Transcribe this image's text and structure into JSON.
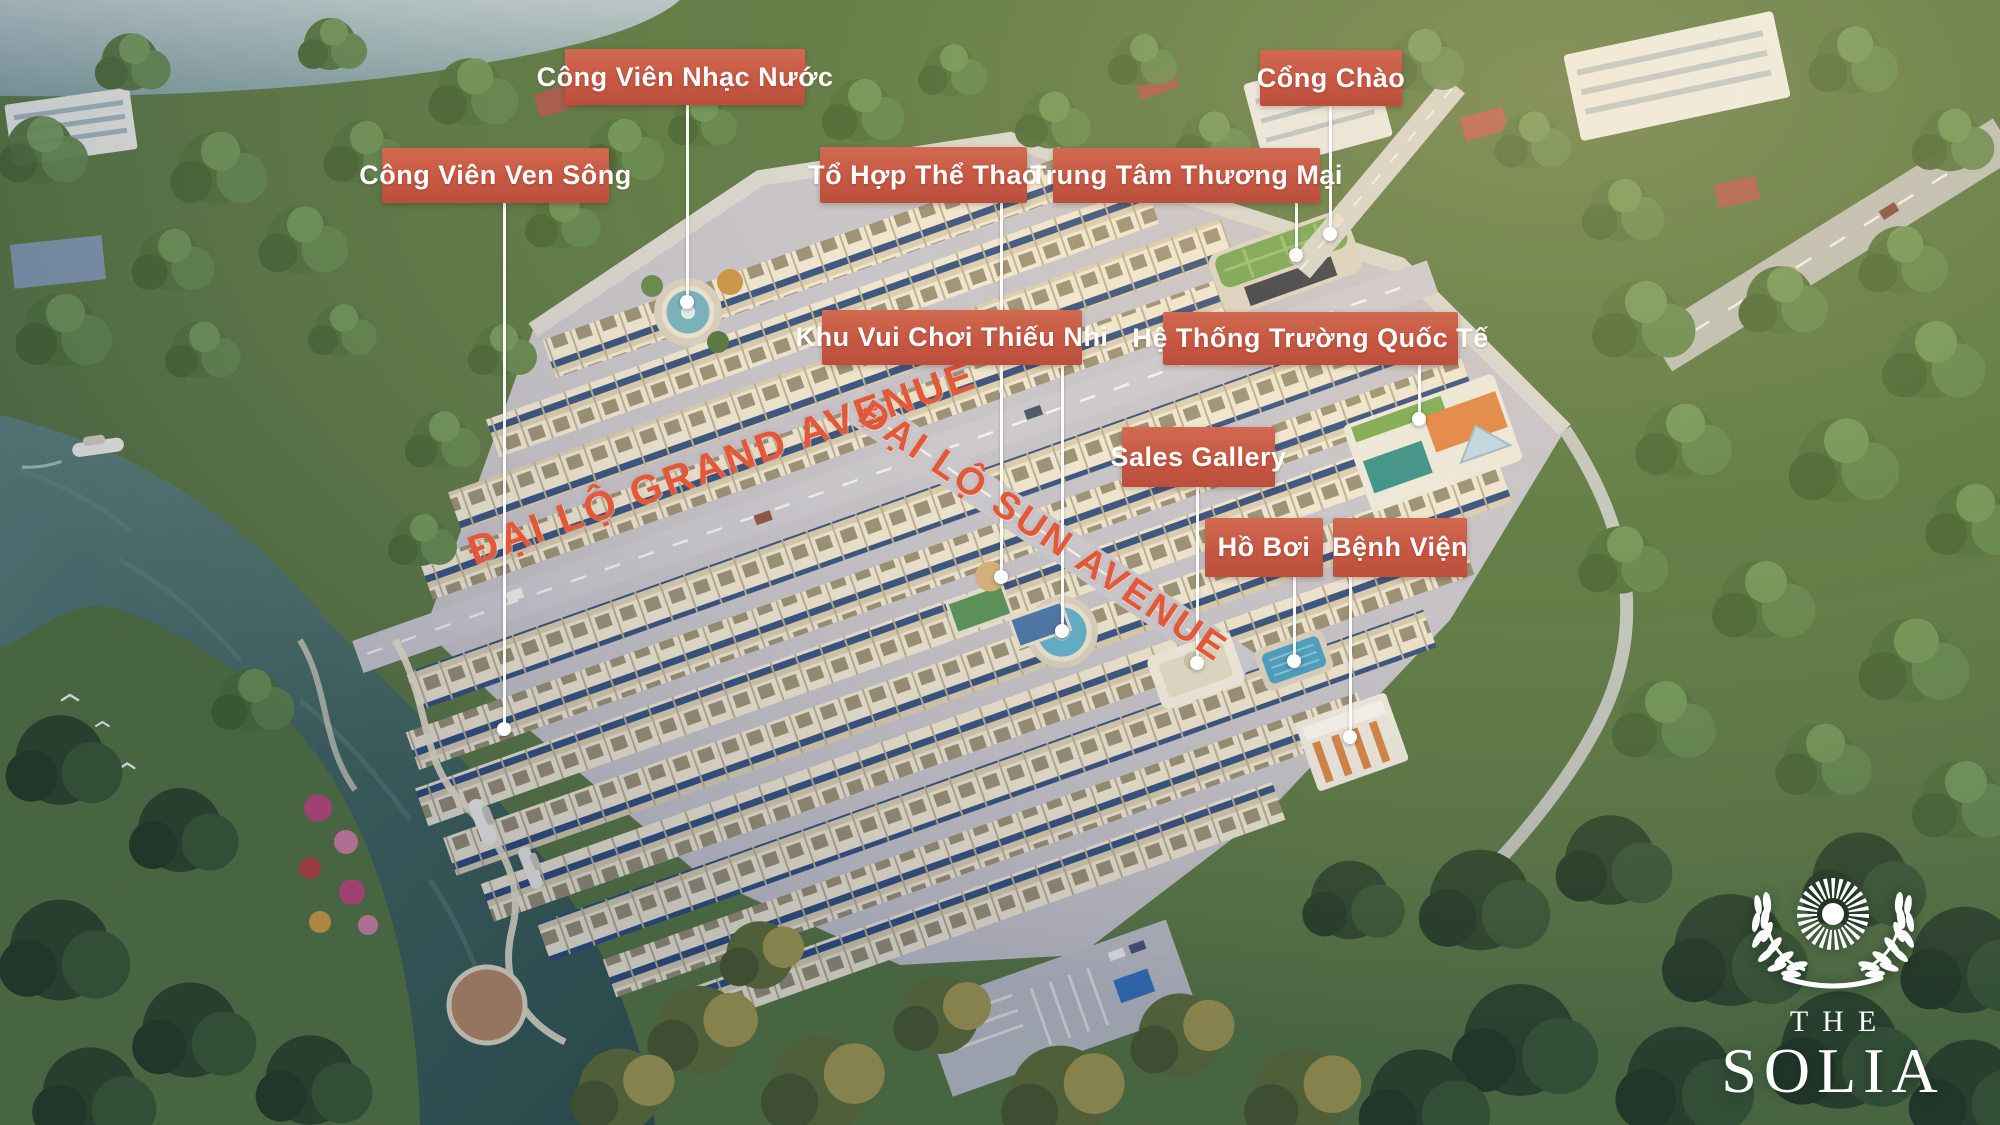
{
  "canvas": {
    "width": 2000,
    "height": 1125
  },
  "colors": {
    "callout_bg": "#c65843",
    "callout_text": "#ffffff",
    "street_text": "#e4583a",
    "leader_line": "#ffffff",
    "river": "#3d625c",
    "lake": "#9fb6bd",
    "forest": "#4e7040",
    "roof_cream": "#efe8d4",
    "facade_navy": "#2c4a7e"
  },
  "callouts": [
    {
      "id": "cong-vien-nhac-nuoc",
      "text": "Công Viên Nhạc Nước",
      "box": {
        "x": 565,
        "y": 49,
        "w": 240,
        "h": 56
      },
      "line": {
        "x": 687,
        "y1": 105,
        "y2": 300
      }
    },
    {
      "id": "cong-chao",
      "text": "Cổng Chào",
      "box": {
        "x": 1260,
        "y": 50,
        "w": 142,
        "h": 56
      },
      "line": {
        "x": 1330,
        "y1": 106,
        "y2": 232
      }
    },
    {
      "id": "cong-vien-ven-song",
      "text": "Công Viên Ven Sông",
      "box": {
        "x": 382,
        "y": 148,
        "w": 227,
        "h": 55
      },
      "line": {
        "x": 504,
        "y1": 203,
        "y2": 727
      }
    },
    {
      "id": "to-hop-the-thao",
      "text": "Tổ Hợp Thể Thao",
      "box": {
        "x": 820,
        "y": 147,
        "w": 207,
        "h": 56
      },
      "line": {
        "x": 1001,
        "y1": 203,
        "y2": 575
      }
    },
    {
      "id": "trung-tam-thuong-mai",
      "text": "Trung Tâm Thương Mại",
      "box": {
        "x": 1053,
        "y": 148,
        "w": 267,
        "h": 55
      },
      "line": {
        "x": 1296,
        "y1": 203,
        "y2": 253
      }
    },
    {
      "id": "khu-vui-choi-thieu-nhi",
      "text": "Khu Vui Chơi Thiếu Nhi",
      "box": {
        "x": 822,
        "y": 310,
        "w": 260,
        "h": 55
      },
      "line": {
        "x": 1062,
        "y1": 365,
        "y2": 629
      }
    },
    {
      "id": "he-thong-truong-quoc-te",
      "text": "Hệ Thống Trường Quốc Tế",
      "box": {
        "x": 1163,
        "y": 312,
        "w": 295,
        "h": 53
      },
      "line": {
        "x": 1419,
        "y1": 365,
        "y2": 417
      }
    },
    {
      "id": "sales-gallery",
      "text": "Sales Gallery",
      "box": {
        "x": 1122,
        "y": 427,
        "w": 153,
        "h": 60
      },
      "line": {
        "x": 1197,
        "y1": 487,
        "y2": 661
      }
    },
    {
      "id": "ho-boi",
      "text": "Hồ Bơi",
      "box": {
        "x": 1205,
        "y": 518,
        "w": 118,
        "h": 59
      },
      "line": {
        "x": 1294,
        "y1": 577,
        "y2": 659
      }
    },
    {
      "id": "benh-vien",
      "text": "Bệnh Viện",
      "box": {
        "x": 1333,
        "y": 518,
        "w": 134,
        "h": 59
      },
      "line": {
        "x": 1350,
        "y1": 577,
        "y2": 735
      }
    }
  ],
  "streets": [
    {
      "id": "grand-avenue",
      "label": "ĐẠI LỘ GRAND AVENUE",
      "cx": 722,
      "cy": 463,
      "angle": -19.5,
      "size": 41
    },
    {
      "id": "sun-avenue",
      "label": "ĐẠI LỘ SUN AVENUE",
      "cx": 1043,
      "cy": 532,
      "angle": 34,
      "size": 38
    }
  ],
  "logo": {
    "the": "THE",
    "name": "SOLIA",
    "x": 1833,
    "y": 868
  }
}
